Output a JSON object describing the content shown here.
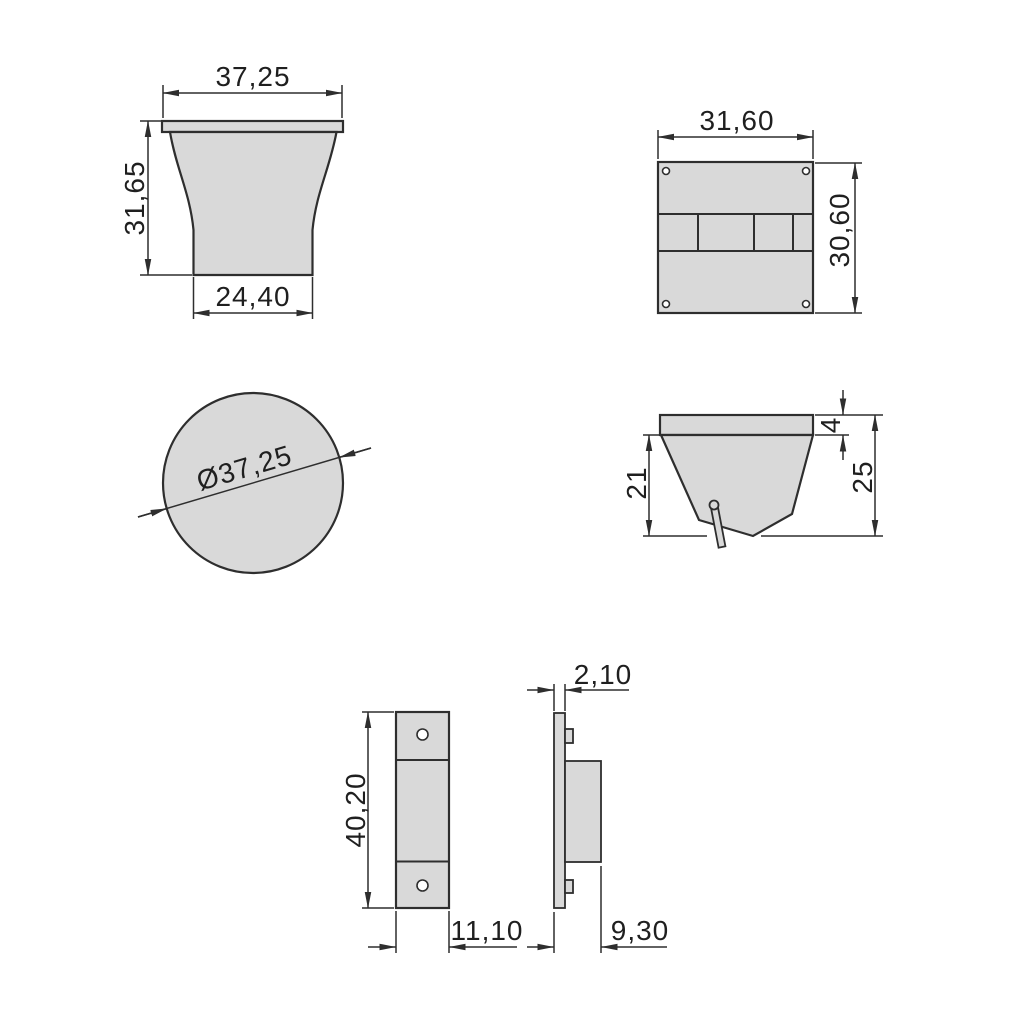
{
  "colors": {
    "background": "#ffffff",
    "part_fill": "#d9d9d9",
    "line": "#2e2e2e",
    "text": "#1f1f1f"
  },
  "views": {
    "knob_front": {
      "top_width": "37,25",
      "height": "31,65",
      "bottom_width": "24,40"
    },
    "plate_back": {
      "width": "31,60",
      "height": "30,60"
    },
    "knob_top": {
      "diameter": "Ø37,25"
    },
    "knob_side": {
      "flange_thickness": "4",
      "body_height": "21",
      "total_height": "25"
    },
    "latch_front": {
      "height": "40,20",
      "width": "11,10"
    },
    "latch_side": {
      "thickness": "2,10",
      "depth": "9,30"
    }
  }
}
